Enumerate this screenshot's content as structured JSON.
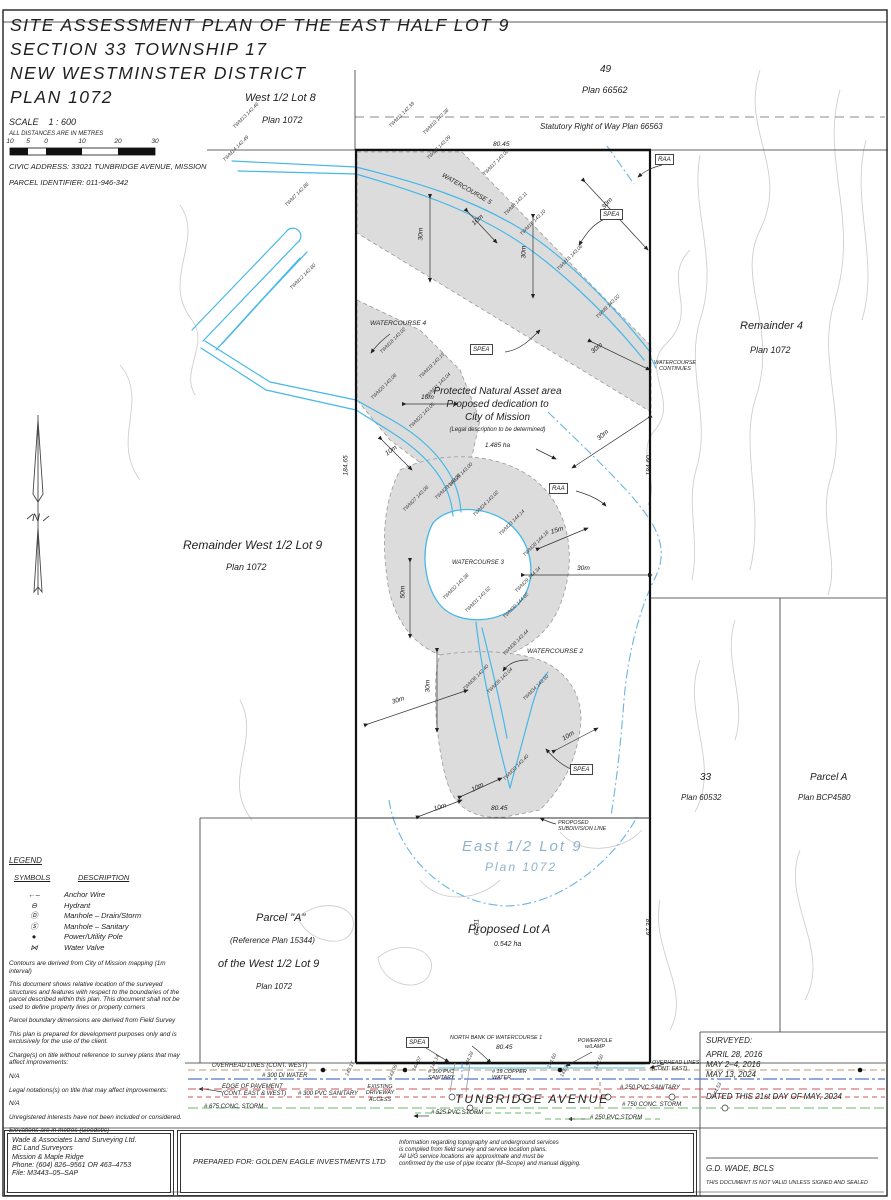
{
  "header": {
    "title_lines": [
      "SITE ASSESSMENT PLAN OF THE EAST HALF LOT 9",
      "SECTION 33 TOWNSHIP 17",
      "NEW WESTMINSTER DISTRICT",
      "PLAN 1072"
    ],
    "scale_label": "SCALE    1 : 600",
    "distances_note": "ALL DISTANCES ARE IN METRES",
    "scale_ticks": [
      "10",
      "5",
      "0",
      "10",
      "20",
      "30"
    ],
    "civic_address": "CIVIC ADDRESS: 33021 TUNBRIDGE AVENUE, MISSION",
    "parcel_identifier": "PARCEL IDENTIFIER: 011-946-342"
  },
  "regions": {
    "west_lot8": {
      "line1": "West 1/2 Lot 8",
      "line2": "Plan 1072"
    },
    "lot49": {
      "line1": "49",
      "line2": "Plan 66562"
    },
    "srw": "Statutory Right of Way Plan 66563",
    "remainder4": {
      "line1": "Remainder 4",
      "line2": "Plan 1072"
    },
    "remainder_west": {
      "line1": "Remainder West 1/2 Lot 9",
      "line2": "Plan 1072"
    },
    "east_half": {
      "line1": "East 1/2 Lot 9",
      "line2": "Plan 1072"
    },
    "proposed_lot_a": {
      "line1": "Proposed Lot A",
      "line2": "0.542 ha"
    },
    "lot33": {
      "line1": "33",
      "line2": "Plan 60532"
    },
    "parcel_a_right": {
      "line1": "Parcel A",
      "line2": "Plan BCP4580"
    },
    "parcel_a_left": {
      "line1": "Parcel \"A\"",
      "line2": "(Reference Plan 15344)",
      "line3": "of the West 1/2 Lot 9",
      "line4": "Plan 1072"
    },
    "pna": {
      "line1": "Protected Natural Asset area",
      "line2": "Proposed dedication to",
      "line3": "City of Mission",
      "line4": "(Legal description to be determined)",
      "line5": "1.485 ha"
    }
  },
  "plan": {
    "watercourse5": "WATERCOURSE 5",
    "watercourse4": "WATERCOURSE 4",
    "watercourse3": "WATERCOURSE 3",
    "watercourse2": "WATERCOURSE 2",
    "watercourse_continues": "WATERCOURSE\nCONTINUES",
    "proposed_subdivision": "PROPOSED\nSUBDIVISION LINE",
    "spea": "SPEA",
    "raa": "RAA",
    "north": "N",
    "floating_labels": [
      {
        "t": "TWM13 142.46",
        "x": 234,
        "y": 125,
        "c": "pt",
        "r": -45
      },
      {
        "t": "TWM14 142.49",
        "x": 224,
        "y": 158,
        "c": "pt",
        "r": -45
      },
      {
        "t": "TWM11 142.39",
        "x": 390,
        "y": 124,
        "c": "pt",
        "r": -45
      },
      {
        "t": "TWM10 142.38",
        "x": 424,
        "y": 131,
        "c": "pt",
        "r": -45
      },
      {
        "t": "TWM7 142.86",
        "x": 286,
        "y": 203,
        "c": "pt",
        "r": -45
      },
      {
        "t": "TWM12 142.80",
        "x": 291,
        "y": 286,
        "c": "pt",
        "r": -45
      },
      {
        "t": "TWM6 143.09",
        "x": 428,
        "y": 156,
        "c": "pt",
        "r": -45
      },
      {
        "t": "TWM17 143.02",
        "x": 484,
        "y": 172,
        "c": "pt",
        "r": -45
      },
      {
        "t": "TWM8 143.11",
        "x": 505,
        "y": 212,
        "c": "pt",
        "r": -45
      },
      {
        "t": "TWM16 143.10",
        "x": 521,
        "y": 232,
        "c": "pt",
        "r": -45
      },
      {
        "t": "TWM15 143.06",
        "x": 558,
        "y": 267,
        "c": "pt",
        "r": -45
      },
      {
        "t": "TWM9 143.02",
        "x": 597,
        "y": 315,
        "c": "pt",
        "r": -45
      },
      {
        "t": "TWM18 143.02",
        "x": 381,
        "y": 350,
        "c": "pt",
        "r": -45
      },
      {
        "t": "TWM20 143.08",
        "x": 372,
        "y": 396,
        "c": "pt",
        "r": -45
      },
      {
        "t": "TWM19 143.15",
        "x": 420,
        "y": 375,
        "c": "pt",
        "r": -45
      },
      {
        "t": "TWM21 143.04",
        "x": 426,
        "y": 395,
        "c": "pt",
        "r": -45
      },
      {
        "t": "TWM22 143.05",
        "x": 410,
        "y": 425,
        "c": "pt",
        "r": -45
      },
      {
        "t": "TWM27 143.06",
        "x": 404,
        "y": 508,
        "c": "pt",
        "r": -45
      },
      {
        "t": "TWM26 143.03",
        "x": 436,
        "y": 496,
        "c": "pt",
        "r": -45
      },
      {
        "t": "TWM25 143.00",
        "x": 448,
        "y": 485,
        "c": "pt",
        "r": -45
      },
      {
        "t": "TWM24 143.02",
        "x": 474,
        "y": 513,
        "c": "pt",
        "r": -45
      },
      {
        "t": "TWM23 144.14",
        "x": 500,
        "y": 532,
        "c": "pt",
        "r": -45
      },
      {
        "t": "TWM28 144.18",
        "x": 524,
        "y": 553,
        "c": "pt",
        "r": -45
      },
      {
        "t": "TWM29 144.34",
        "x": 516,
        "y": 589,
        "c": "pt",
        "r": -45
      },
      {
        "t": "TWM30 144.02",
        "x": 504,
        "y": 615,
        "c": "pt",
        "r": -45
      },
      {
        "t": "TWM31 143.52",
        "x": 466,
        "y": 609,
        "c": "pt",
        "r": -45
      },
      {
        "t": "TWM32 143.38",
        "x": 444,
        "y": 596,
        "c": "pt",
        "r": -45
      },
      {
        "t": "TWM38 143.44",
        "x": 504,
        "y": 652,
        "c": "pt",
        "r": -45
      },
      {
        "t": "TWM36 142.40",
        "x": 464,
        "y": 687,
        "c": "pt",
        "r": -45
      },
      {
        "t": "TWM35 143.04",
        "x": 488,
        "y": 690,
        "c": "pt",
        "r": -45
      },
      {
        "t": "TWM34 143.50",
        "x": 524,
        "y": 697,
        "c": "pt",
        "r": -45
      },
      {
        "t": "TWM33 143.40",
        "x": 504,
        "y": 777,
        "c": "pt",
        "r": -45
      },
      {
        "t": "143.37",
        "x": 347,
        "y": 1073,
        "c": "pt",
        "r": -65
      },
      {
        "t": "143.05",
        "x": 390,
        "y": 1076,
        "c": "pt",
        "r": -65
      },
      {
        "t": "144.07",
        "x": 414,
        "y": 1068,
        "c": "pt",
        "r": -65
      },
      {
        "t": "144.14",
        "x": 432,
        "y": 1066,
        "c": "pt",
        "r": -65
      },
      {
        "t": "144.28",
        "x": 466,
        "y": 1063,
        "c": "pt",
        "r": -65
      },
      {
        "t": "144.60",
        "x": 549,
        "y": 1065,
        "c": "pt",
        "r": -65
      },
      {
        "t": "143.18",
        "x": 562,
        "y": 1074,
        "c": "pt",
        "r": -65
      },
      {
        "t": "144.50",
        "x": 596,
        "y": 1066,
        "c": "pt",
        "r": -65
      },
      {
        "t": "144.53",
        "x": 714,
        "y": 1094,
        "c": "pt",
        "r": -65
      },
      {
        "t": "80.45",
        "x": 493,
        "y": 141,
        "c": "dim",
        "r": 0
      },
      {
        "t": "184.65",
        "x": 346,
        "y": 472,
        "c": "dim",
        "r": -90
      },
      {
        "t": "184.60",
        "x": 649,
        "y": 472,
        "c": "dim",
        "r": -90
      },
      {
        "t": "80.45",
        "x": 491,
        "y": 805,
        "c": "dim",
        "r": 0
      },
      {
        "t": "67.31",
        "x": 477,
        "y": 932,
        "c": "dim",
        "r": -90
      },
      {
        "t": "67.38",
        "x": 649,
        "y": 932,
        "c": "dim",
        "r": -90
      },
      {
        "t": "80.45",
        "x": 496,
        "y": 1044,
        "c": "dim",
        "r": 0
      },
      {
        "t": "30m",
        "x": 421,
        "y": 237,
        "c": "dim",
        "r": -90
      },
      {
        "t": "30m",
        "x": 524,
        "y": 255,
        "c": "dim",
        "r": -90
      },
      {
        "t": "10m",
        "x": 473,
        "y": 221,
        "c": "dim",
        "r": -42
      },
      {
        "t": "30m",
        "x": 603,
        "y": 205,
        "c": "dim",
        "r": -48
      },
      {
        "t": "10m",
        "x": 421,
        "y": 394,
        "c": "dim",
        "r": 0
      },
      {
        "t": "10m",
        "x": 386,
        "y": 451,
        "c": "dim",
        "r": -35
      },
      {
        "t": "30m",
        "x": 598,
        "y": 436,
        "c": "dim",
        "r": -40
      },
      {
        "t": "15m",
        "x": 551,
        "y": 529,
        "c": "dim",
        "r": -18
      },
      {
        "t": "30m",
        "x": 577,
        "y": 565,
        "c": "dim",
        "r": 0
      },
      {
        "t": "50m",
        "x": 403,
        "y": 595,
        "c": "dim",
        "r": -90
      },
      {
        "t": "30m",
        "x": 428,
        "y": 689,
        "c": "dim",
        "r": -90
      },
      {
        "t": "30m",
        "x": 392,
        "y": 699,
        "c": "dim",
        "r": -18
      },
      {
        "t": "10m",
        "x": 563,
        "y": 736,
        "c": "dim",
        "r": -32
      },
      {
        "t": "10m",
        "x": 472,
        "y": 787,
        "c": "dim",
        "r": -28
      },
      {
        "t": "10m",
        "x": 434,
        "y": 806,
        "c": "dim",
        "r": -18
      },
      {
        "t": "30m",
        "x": 592,
        "y": 349,
        "c": "dim",
        "r": -40
      }
    ]
  },
  "road": {
    "overhead_west": "OVERHEAD LINES (CONT. WEST)",
    "di_water": "# 300 DI WATER",
    "edge_pavement": "EDGE OF PAVEMENT\n(CONT. EAST & WEST)",
    "pvc_sanitary_300": "# 300 PVC SANITARY",
    "existing_driveway": "EXISTING\nDRIVEWAY\nACCESS",
    "conc_storm_675": "# 675 CONC. STORM",
    "pvc_storm_525": "# 525 PVC STORM",
    "pvc_sanitary_100": "# 100 PVC\nSANITARY",
    "copper_water": "# 19 COPPER\nWATER",
    "north_bank": "NORTH BANK OF WATERCOURSE 1",
    "powerpole": "POWERPOLE\nw/LAMP",
    "overhead_east": "OVERHEAD LINES\n(CONT. EAST)",
    "pvc_sanitary_250": "# 250 PVC SANITARY",
    "street": "TUNBRIDGE AVENUE",
    "conc_storm_750": "# 750 CONC. STORM",
    "pvc_storm_250": "# 250 PVC STORM"
  },
  "legend": {
    "title": "LEGEND",
    "col_symbols": "SYMBOLS",
    "col_description": "DESCRIPTION",
    "items": [
      {
        "symbol": "←–",
        "desc": "Anchor Wire"
      },
      {
        "symbol": "⊖",
        "desc": "Hydrant"
      },
      {
        "symbol": "Ⓓ",
        "desc": "Manhole – Drain/Storm"
      },
      {
        "symbol": "Ⓢ",
        "desc": "Manhole – Sanitary"
      },
      {
        "symbol": "●",
        "desc": "Power/Utility Pole"
      },
      {
        "symbol": "⋈",
        "desc": "Water Valve"
      }
    ]
  },
  "notes": [
    "Contours are derived from City of Mission mapping (1m interval)",
    "This document shows relative location of the surveyed structures and features with respect to the boundaries of the parcel described within this plan. This document shall not be used to define property lines or property corners",
    "Parcel boundary dimensions are derived from Field Survey",
    "This plan is prepared for development purposes only and is exclusively for the use of the client.",
    "Charge(s) on title without reference to survey plans that may affect improvements:",
    "N/A",
    "Legal notations(s) on title that may affect improvements:",
    "N/A",
    "Unregistered interests have not been included or considered.",
    "Elevations are in metres (Geodetic)\nElevations are derived from Wade Control Pt No. 14138\nElevation = 143.72m\nDatum = CGVD28 (HTv2.0)"
  ],
  "titlebar": {
    "company_lines": [
      "Wade & Associates Land Surveying Ltd.",
      "BC Land Surveyors",
      "Mission & Maple Ridge",
      "Phone: (604) 826–9561 OR 463–4753",
      "File: M3443–05–SAP"
    ],
    "prepared_for": "PREPARED FOR: GOLDEN EAGLE INVESTMENTS LTD",
    "info": "Information regarding topography and underground services\nis compiled from field survey and service location plans.\nAll U/G service locations are approximate and must be\nconfirmed by the use of pipe locator (M–Scope) and manual digging.",
    "surveyed_title": "SURVEYED:",
    "surveyed_dates": [
      "APRIL 28, 2016",
      "MAY 2–4, 2016",
      "MAY 13, 2024"
    ],
    "dated": "DATED THIS 21st DAY OF MAY, 2024",
    "signer": "G.D. WADE, BCLS",
    "validity": "THIS DOCUMENT IS NOT VALID UNLESS SIGNED AND SEALED"
  },
  "colors": {
    "water_blue": "#45b8e8",
    "raa_blue": "#6ab4e4",
    "spea_gray": "#dcdcdc",
    "contour_gray": "#cfcfcf",
    "overhead_tan": "#b89a6e",
    "watermain_blue": "#5078c8",
    "pavement_red": "#cc5555",
    "storm_green": "#6cb86c",
    "east_text_blue": "#8fb3cd"
  }
}
